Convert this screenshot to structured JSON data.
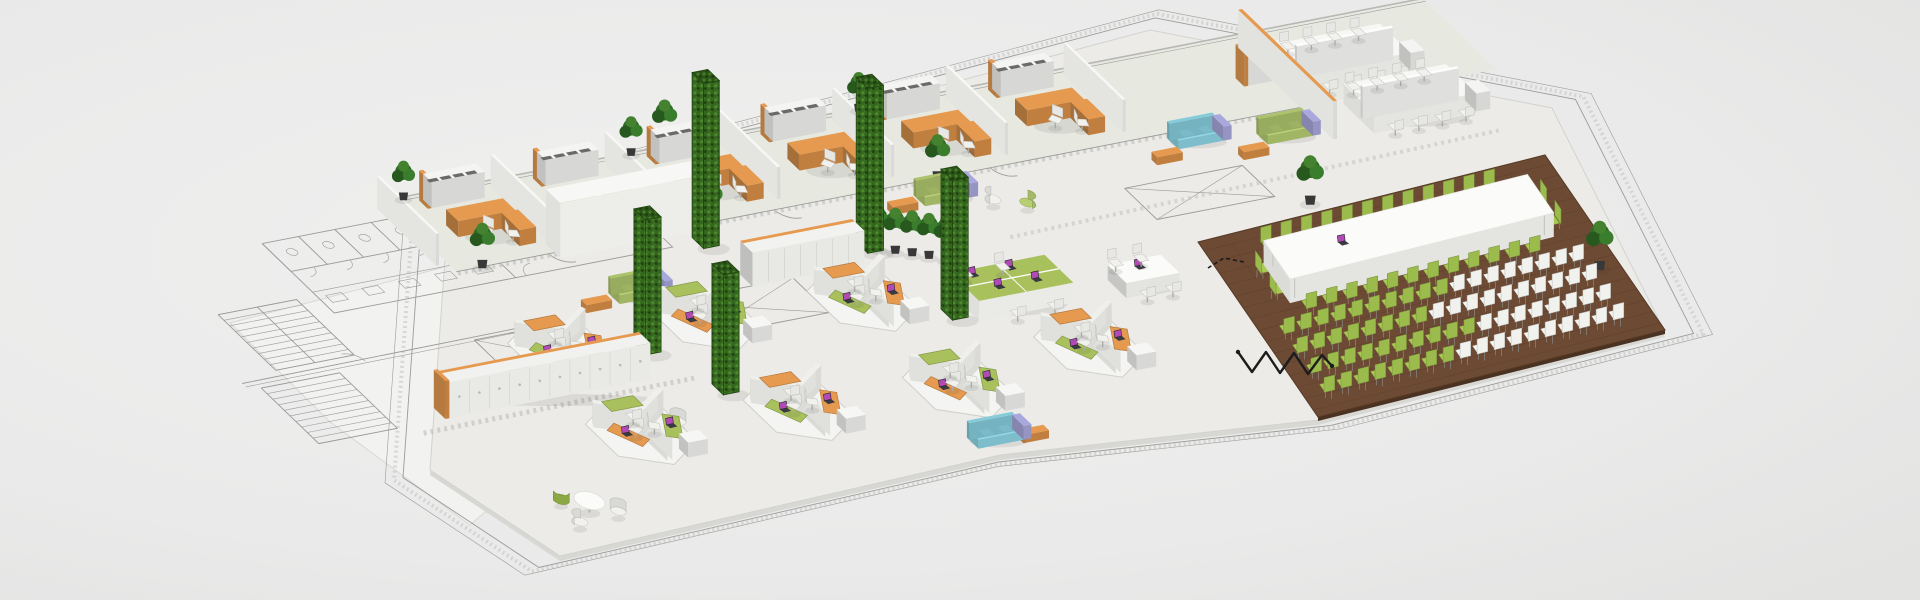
{
  "scene": {
    "title": "Isometric office floor plan render",
    "description": "3D isometric rendering of a large open-plan office floor placed over a CAD blueprint: a row of private offices with orange U-shaped desks, white bench desks, lounge sofas, green living-wall pillars, hexagonal workstation clusters with orange and green desks, locker rows, and a boardroom zone on dark walnut flooring with a long white table and rows of green and white chairs.",
    "background_color": "#eaeaea",
    "palette": {
      "plate": "#ecebe8",
      "plate_edge": "#d7d7d3",
      "office_floor": "#e7e9e1",
      "blueprint_line": "#9b9b99",
      "blueprint_fill": "#f2f2f0",
      "hatch": "#c5c5c1",
      "wood_floor": "#6d4a33",
      "wood_line": "#5d3f2b",
      "wood_edge": "#4a3122",
      "desk_orange": "#e59a50",
      "desk_orange_side": "#c07f3e",
      "desk_green": "#a9c15c",
      "locker_white": "#f1f1ef",
      "wall_white": "#f7f7f5",
      "partition_gray": "#d9d9d5",
      "hedge_green": "#35661f",
      "hedge_light": "#4d8a2c",
      "hedge_dark": "#20430f",
      "plant_green": "#2f6b27",
      "pot_dark": "#383838",
      "sofa_blue": "#8fd8e8",
      "sofa_green": "#b7cf72",
      "sofa_lavender": "#a9a8dd",
      "chair_white": "#f1f1ee",
      "chair_gray": "#c9c9c6",
      "chair_green": "#9cbb4d",
      "table_white": "#fbfbf9",
      "laptop_body": "#3a3a42",
      "laptop_screen": "#b14ab4",
      "cable_black": "#1c1c1c",
      "shadow": "rgba(60,60,60,0.10)"
    },
    "zones": {
      "blueprint": {
        "features": [
          "staircase",
          "restroom-stalls",
          "door-swings",
          "shaft-x-marks",
          "double-line-walls"
        ]
      },
      "private_offices": {
        "count": 6,
        "desk_shape": "U-shaped",
        "desk_color": "#e59a50",
        "chairs_per_office": 2,
        "storage": "white cabinet with orange end panel"
      },
      "bench_desks": {
        "islands": 2,
        "seats_per_island": 4,
        "divider": "white privacy screen"
      },
      "lounge": {
        "blue_sofas": 2,
        "green_sofas": 3,
        "accent_panel_color": "#a9a8dd",
        "orange_benches": 5,
        "armchairs": 10
      },
      "green_wall_pillars": {
        "count": 5,
        "color": "#35661f"
      },
      "potted_plants": {
        "count": 14
      },
      "lockers": {
        "rows": 2,
        "door_count": 17,
        "top_trim_color": "#e59a50"
      },
      "open_plan": {
        "hex_clusters": 7,
        "desks_per_cluster": 3,
        "desk_colors": [
          "#e59a50",
          "#a9c15c"
        ],
        "green_bench_desk_seats": 4,
        "round_meeting_tables": 2,
        "rect_meeting_tables": 1
      },
      "conference": {
        "floor": "dark walnut planks",
        "floor_color": "#6d4a33",
        "table_color": "#fbfbf9",
        "table_side_seats": 24,
        "table_end_seats": 4,
        "audience_rows": 4,
        "audience_seats_per_row": 18,
        "chair_colors": [
          "#9cbb4d",
          "#f2f2f0"
        ],
        "laptops_on_table": 1,
        "cable": "black zigzag"
      }
    },
    "laptops": {
      "count": 19,
      "screen_color": "#b14ab4"
    }
  }
}
